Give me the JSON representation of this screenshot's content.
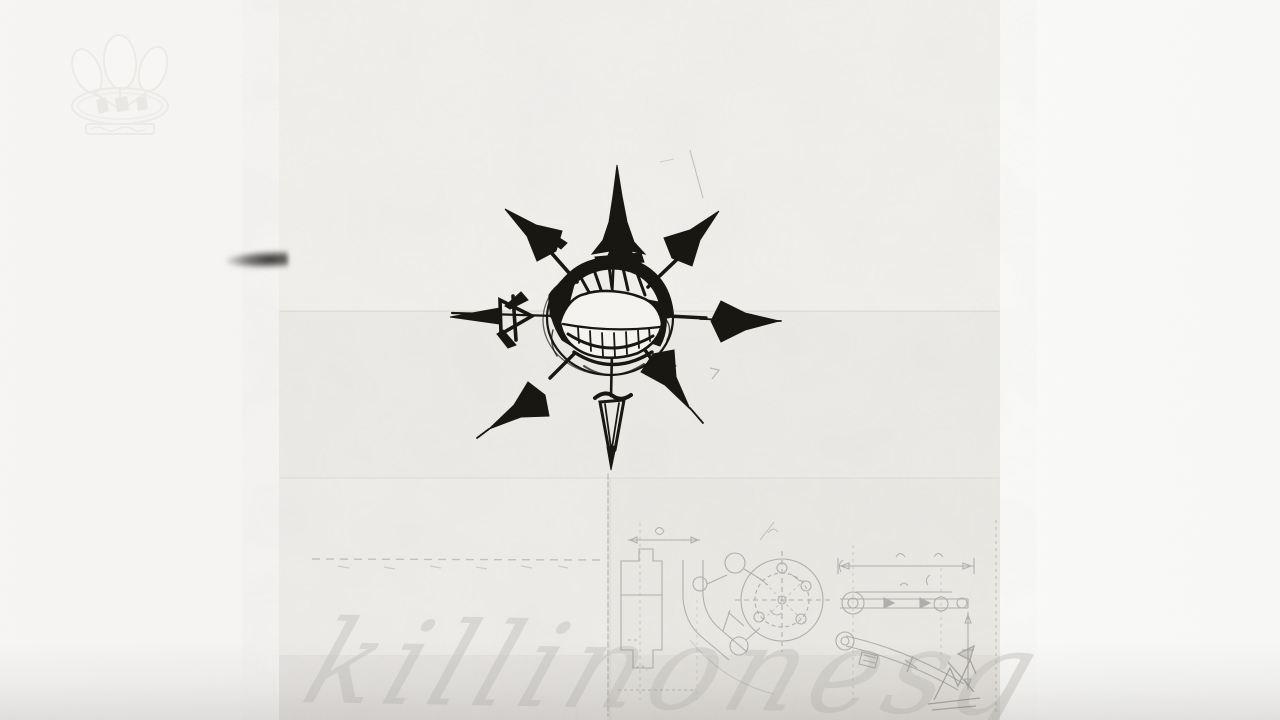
{
  "artwork": {
    "handwritten_title": "killinonesg",
    "ink_color": "#16140f",
    "pencil_sketch_color": "#8e8d8a",
    "script_color": "#c6c4bf",
    "paper_color": "#f2f1ee",
    "background_left_color": "#f7f6f5",
    "background_right_color": "#fbfbfa"
  },
  "icons": {
    "chaos_star": "eight-arrow-chaos-star-with-grin",
    "watermark": "balloon-crest-watermark",
    "smudge": "ink-smudge"
  }
}
